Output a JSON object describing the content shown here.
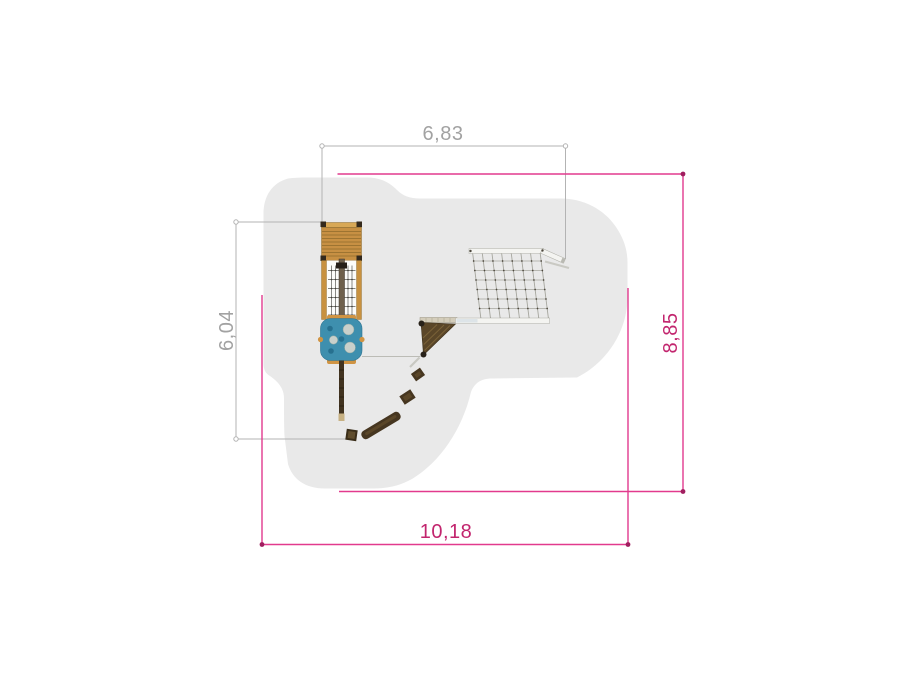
{
  "drawing": {
    "dimension_labels": {
      "equipment_width_top": "6,83",
      "equipment_depth_left": "6,04",
      "safety_area_height_right": "8,85",
      "safety_area_width_bottom": "10,18"
    },
    "colors": {
      "safety_area_fill": "#e9e9e9",
      "dimension_gray_line": "#b3b3b3",
      "dimension_gray_text": "#a2a2a2",
      "dimension_magenta_line": "#e23a8e",
      "dimension_magenta_dot": "#a01e5f",
      "dimension_magenta_text": "#c2256e",
      "wood": "#c79043",
      "panel_blue": "#3e8fae"
    }
  }
}
